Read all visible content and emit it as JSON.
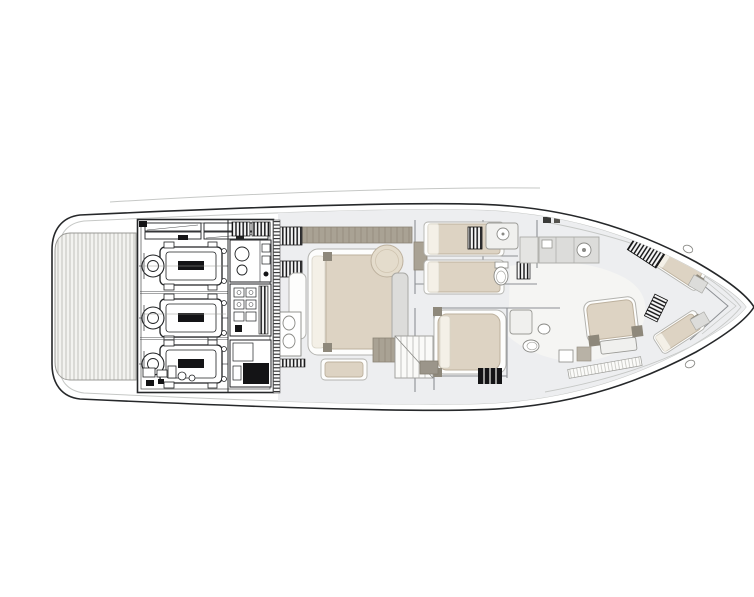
{
  "meta": {
    "title": "Yacht lower deck floor plan",
    "description": "Black-and-white naval architecture drawing, top view of a motor yacht lower deck: hatched swim platform and dense engine room with three engines aft (left side), master cabin with double bed, twin-bed guest cabin, bathrooms, central staircase, forward VIP cabin and two angled bow berths toward the pointed bow (right side)."
  },
  "colors": {
    "bg": "#ffffff",
    "hull_line": "#26282a",
    "detail_line": "#4c4e50",
    "wall_line": "#8d9094",
    "faint_line": "#c6c8c6",
    "hull_fill": "#ffffff",
    "floor": "#edeef0",
    "floor_light": "#f5f5f3",
    "deck_stripe": "#bcbcb6",
    "bed": "#ddd3c3",
    "bed_light": "#e4dccc",
    "bed_outline": "#bdb19e",
    "pillow": "#f4f0e7",
    "taupe": "#a9a294",
    "taupe_dark": "#8e887b",
    "sofa": "#dcdcda",
    "black": "#141416"
  },
  "elements": [
    "hull-outline",
    "swim-platform",
    "engine-room",
    "engine-1",
    "engine-2",
    "engine-3",
    "equipment-rack",
    "bulkhead-hatching",
    "master-cabin",
    "master-bed",
    "ottoman",
    "master-sofa",
    "vanity-sinks",
    "twin-cabin",
    "twin-bed-1",
    "twin-bed-2",
    "toilet",
    "shower",
    "galley-counter",
    "sink",
    "vip-cabin",
    "vip-bed",
    "floor-grate",
    "staircase",
    "forward-cabin",
    "forward-bed",
    "bow-berth-port",
    "bow-berth-starboard",
    "companionway-stairs",
    "deck-hatch",
    "anchor-locker"
  ]
}
